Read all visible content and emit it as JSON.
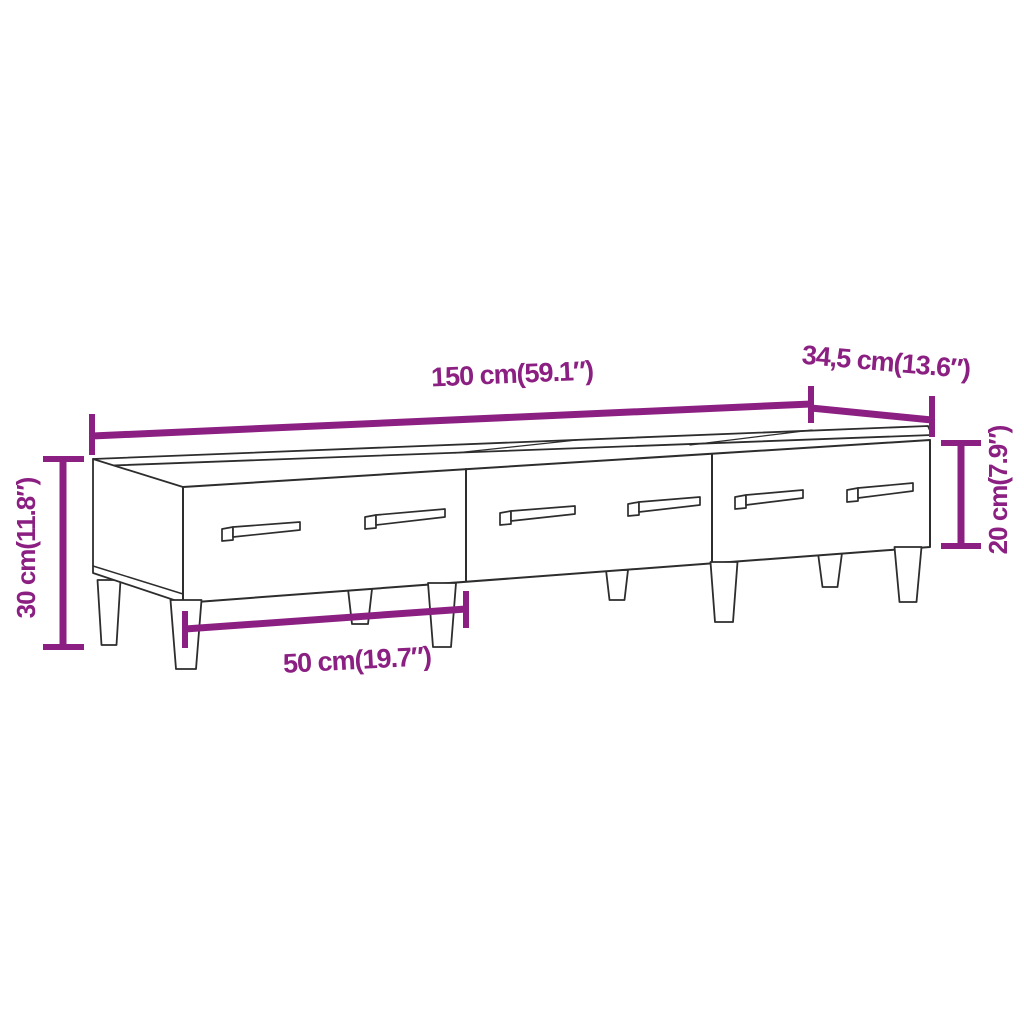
{
  "diagram": {
    "accent_color": "#8B2082",
    "outline_color": "#2d2d2d",
    "background_color": "#ffffff",
    "dimensions": {
      "width": {
        "label": "150 cm(59.1″)",
        "value_cm": 150,
        "value_in": 59.1
      },
      "depth": {
        "label": "34,5 cm(13.6″)",
        "value_cm": 34.5,
        "value_in": 13.6
      },
      "total_height": {
        "label": "30 cm(11.8″)",
        "value_cm": 30,
        "value_in": 11.8
      },
      "body_height": {
        "label": "20 cm(7.9″)",
        "value_cm": 20,
        "value_in": 7.9
      },
      "drawer_width": {
        "label": "50 cm(19.7″)",
        "value_cm": 50,
        "value_in": 19.7
      }
    }
  }
}
